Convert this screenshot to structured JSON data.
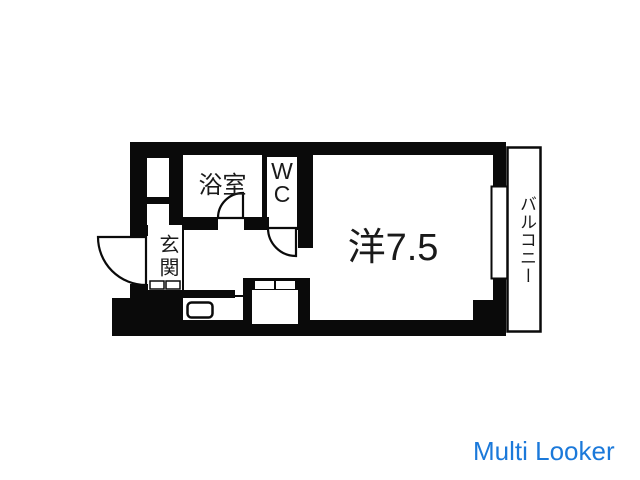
{
  "labels": {
    "bathroom": "浴室",
    "toilet": "WC",
    "entrance": "玄関",
    "main_room": "洋7.5",
    "balcony": "バルコニー"
  },
  "watermark": {
    "text": "Multi Looker",
    "color": "#1b79da"
  },
  "colors": {
    "wall": "#0a0a0a",
    "background": "#ffffff",
    "label_text": "#1a1a1a"
  }
}
